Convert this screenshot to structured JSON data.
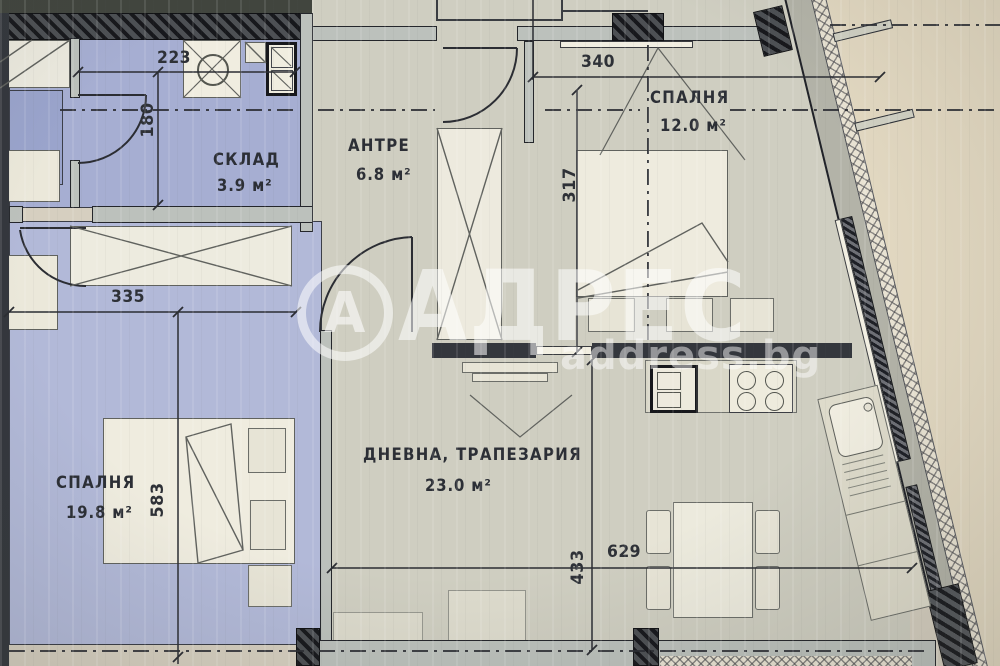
{
  "plan_title": "Apartment floor plan",
  "watermark": {
    "logo_letter": "А",
    "brand": "АДРЕС",
    "domain": "address.bg"
  },
  "rooms": [
    {
      "name": "СКЛАД",
      "area": "3.9 м²"
    },
    {
      "name": "АНТРЕ",
      "area": "6.8 м²"
    },
    {
      "name": "СПАЛНЯ",
      "area": "12.0 м²"
    },
    {
      "name": "ДНЕВНА, ТРАПЕЗАРИЯ",
      "area": "23.0 м²"
    },
    {
      "name": "СПАЛНЯ",
      "area": "19.8 м²"
    }
  ],
  "dims": {
    "d223": "223",
    "d180": "180",
    "d340": "340",
    "d317": "317",
    "d335": "335",
    "d583": "583",
    "d629": "629",
    "d433": "433"
  },
  "colors": {
    "paper": "#d6cfc0",
    "outside": "#e2d8c1",
    "floor_main": "#cfcec1",
    "floor_blue": "#a6aed2",
    "floor_blue_bedroom": "#b2b9d8",
    "wall_dark": "#34373d",
    "wall_gray": "#bcc1bc",
    "ink": "#2e3137",
    "watermark_white": "#ffffff"
  }
}
